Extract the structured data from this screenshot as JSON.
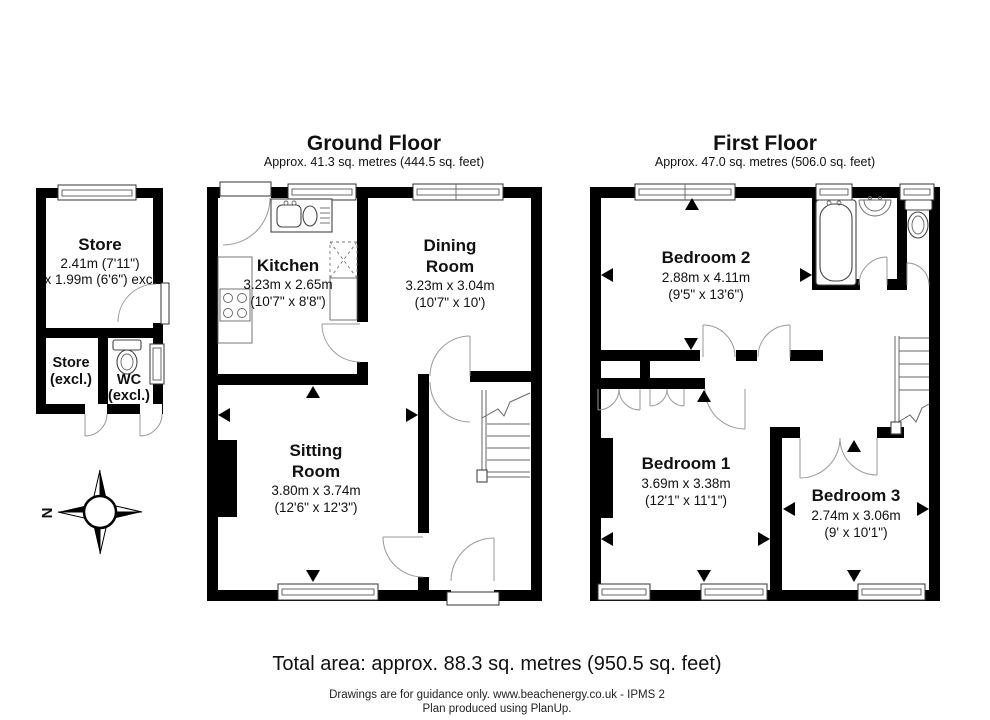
{
  "ground_floor": {
    "title": "Ground Floor",
    "subtitle": "Approx. 41.3 sq. metres (444.5 sq. feet)",
    "rooms": {
      "kitchen": {
        "name": "Kitchen",
        "metric": "3.23m x 2.65m",
        "imperial": "(10'7\" x 8'8\")"
      },
      "dining": {
        "name_line1": "Dining",
        "name_line2": "Room",
        "metric": "3.23m x 3.04m",
        "imperial": "(10'7\" x 10')"
      },
      "sitting": {
        "name_line1": "Sitting",
        "name_line2": "Room",
        "metric": "3.80m x 3.74m",
        "imperial": "(12'6\" x 12'3\")"
      }
    }
  },
  "first_floor": {
    "title": "First Floor",
    "subtitle": "Approx. 47.0 sq. metres (506.0 sq. feet)",
    "rooms": {
      "bedroom1": {
        "name": "Bedroom 1",
        "metric": "3.69m x 3.38m",
        "imperial": "(12'1\" x 11'1\")"
      },
      "bedroom2": {
        "name": "Bedroom 2",
        "metric": "2.88m x 4.11m",
        "imperial": "(9'5\" x 13'6\")"
      },
      "bedroom3": {
        "name": "Bedroom 3",
        "metric": "2.74m x 3.06m",
        "imperial": "(9' x 10'1\")"
      }
    }
  },
  "outbuilding": {
    "store": {
      "name": "Store",
      "metric": "2.41m (7'11\")",
      "metric2": "x 1.99m (6'6\") excl"
    },
    "store_excl": {
      "name": "Store",
      "suffix": "(excl.)"
    },
    "wc": {
      "name": "WC",
      "suffix": "(excl.)"
    }
  },
  "compass": {
    "north_label": "N"
  },
  "footer": {
    "total_area": "Total area: approx. 88.3 sq. metres (950.5 sq. feet)",
    "disclaimer": "Drawings are for guidance only. www.beachenergy.co.uk - IPMS 2",
    "produced": "Plan produced using PlanUp."
  },
  "colors": {
    "wall": "#000000",
    "background": "#ffffff",
    "line": "#666666"
  }
}
